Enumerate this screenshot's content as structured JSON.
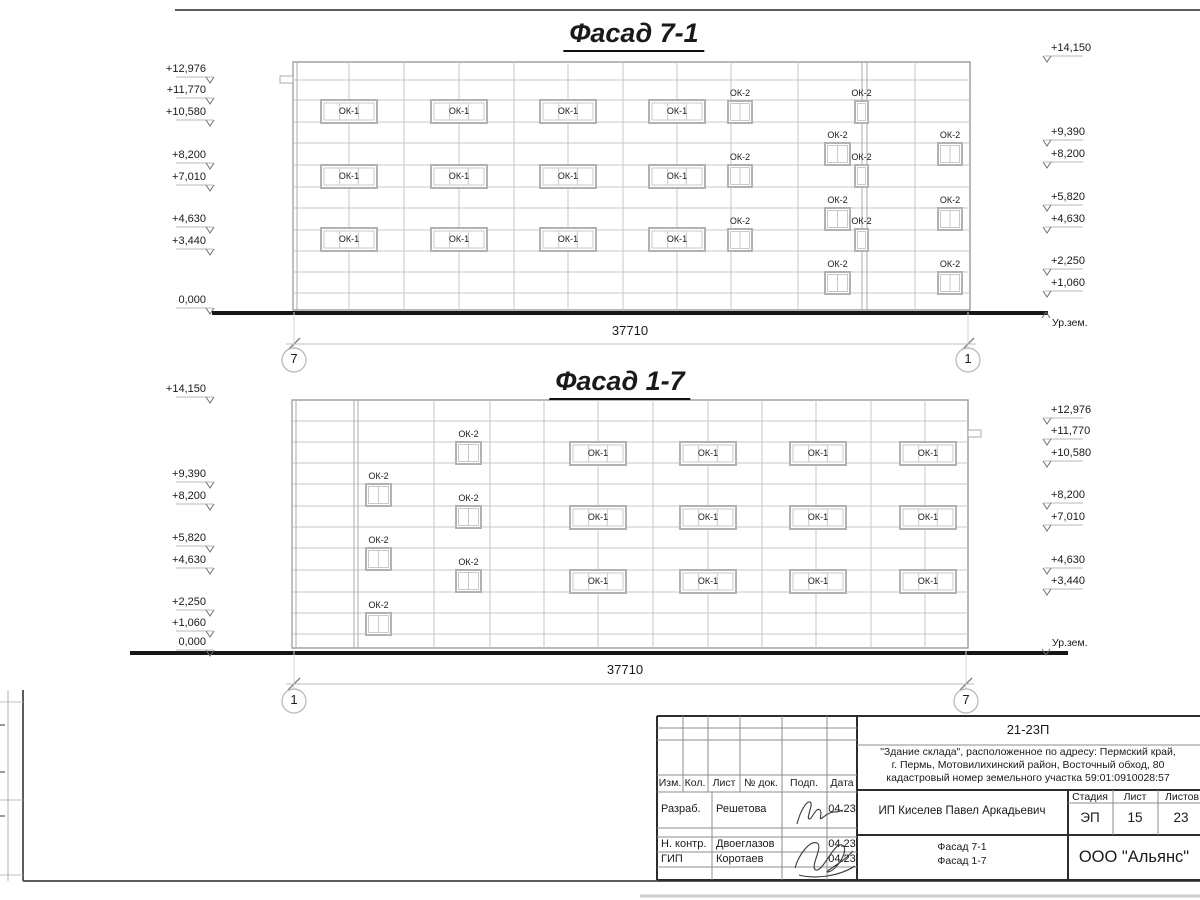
{
  "facades": [
    {
      "title": "Фасад 7-1",
      "title_x": 634,
      "title_y": 18,
      "left": 293,
      "right": 970,
      "top": 62,
      "bottom": 310,
      "h_lines": [
        80,
        100,
        122,
        143,
        165,
        187,
        208,
        230,
        251,
        272,
        293
      ],
      "v_lines": [
        349,
        404,
        459,
        514,
        568,
        623,
        677,
        731,
        798,
        915
      ],
      "v_double": [
        [
          293,
          297
        ],
        [
          862,
          867
        ]
      ],
      "notch": {
        "x": 280,
        "y": 76,
        "w": 13,
        "h": 7
      },
      "ok1_label": "ОК-1",
      "ok1_cols": [
        349,
        459,
        568,
        677
      ],
      "ok1_rows": [
        100,
        165,
        228
      ],
      "ok1_w": 56,
      "ok1_h": 23,
      "ok2_label": "ОК-2",
      "ok2_h": 22,
      "ok2": [
        {
          "x": 728,
          "y": 101,
          "w": 24
        },
        {
          "x": 728,
          "y": 165,
          "w": 24
        },
        {
          "x": 728,
          "y": 229,
          "w": 24
        },
        {
          "x": 855,
          "y": 101,
          "w": 13
        },
        {
          "x": 855,
          "y": 165,
          "w": 13
        },
        {
          "x": 855,
          "y": 229,
          "w": 13
        },
        {
          "x": 825,
          "y": 143,
          "w": 25
        },
        {
          "x": 825,
          "y": 208,
          "w": 25
        },
        {
          "x": 825,
          "y": 272,
          "w": 25
        },
        {
          "x": 938,
          "y": 143,
          "w": 24
        },
        {
          "x": 938,
          "y": 208,
          "w": 24
        },
        {
          "x": 938,
          "y": 272,
          "w": 24
        }
      ],
      "ground": {
        "x1": 212,
        "x2": 1048,
        "y": 313
      },
      "dim": {
        "text": "37710",
        "x1": 294,
        "x2": 968,
        "y": 344,
        "tx": 630,
        "ty": 324
      },
      "bubble_y": 360,
      "bubbles": [
        {
          "label": "7",
          "x": 294
        },
        {
          "label": "1",
          "x": 968
        }
      ],
      "marks_left": {
        "tick_x": 210,
        "items": [
          {
            "label": "+12,976",
            "y": 77
          },
          {
            "label": "+11,770",
            "y": 98
          },
          {
            "label": "+10,580",
            "y": 120
          },
          {
            "label": "+8,200",
            "y": 163
          },
          {
            "label": "+7,010",
            "y": 185
          },
          {
            "label": "+4,630",
            "y": 227
          },
          {
            "label": "+3,440",
            "y": 249
          },
          {
            "label": "0,000",
            "y": 308
          }
        ]
      },
      "marks_right": {
        "tick_x": 1047,
        "items": [
          {
            "label": "+14,150",
            "y": 56
          },
          {
            "label": "+9,390",
            "y": 140
          },
          {
            "label": "+8,200",
            "y": 162
          },
          {
            "label": "+5,820",
            "y": 205
          },
          {
            "label": "+4,630",
            "y": 227
          },
          {
            "label": "+2,250",
            "y": 269
          },
          {
            "label": "+1,060",
            "y": 291
          }
        ]
      },
      "ur_zem": {
        "label": "Ур.зем.",
        "x": 1052,
        "y": 317,
        "dir": "up"
      }
    },
    {
      "title": "Фасад 1-7",
      "title_x": 620,
      "title_y": 366,
      "left": 292,
      "right": 968,
      "top": 400,
      "bottom": 648,
      "h_lines": [
        421,
        442,
        463,
        484,
        506,
        527,
        548,
        570,
        592,
        613,
        634
      ],
      "v_lines": [
        434,
        490,
        544,
        598,
        653,
        708,
        762,
        816,
        871,
        925
      ],
      "v_double": [
        [
          292,
          296
        ],
        [
          354,
          358
        ]
      ],
      "notch": {
        "x": 968,
        "y": 430,
        "w": 13,
        "h": 7
      },
      "ok1_label": "ОК-1",
      "ok1_cols": [
        598,
        708,
        818,
        928
      ],
      "ok1_rows": [
        442,
        506,
        570
      ],
      "ok1_w": 56,
      "ok1_h": 23,
      "ok2_label": "ОК-2",
      "ok2_h": 22,
      "ok2": [
        {
          "x": 366,
          "y": 484,
          "w": 25
        },
        {
          "x": 366,
          "y": 548,
          "w": 25
        },
        {
          "x": 366,
          "y": 613,
          "w": 25
        },
        {
          "x": 456,
          "y": 442,
          "w": 25
        },
        {
          "x": 456,
          "y": 506,
          "w": 25
        },
        {
          "x": 456,
          "y": 570,
          "w": 25
        }
      ],
      "ground": {
        "x1": 130,
        "x2": 1068,
        "y": 653
      },
      "dim": {
        "text": "37710",
        "x1": 294,
        "x2": 966,
        "y": 684,
        "tx": 625,
        "ty": 663
      },
      "bubble_y": 701,
      "bubbles": [
        {
          "label": "1",
          "x": 294
        },
        {
          "label": "7",
          "x": 966
        }
      ],
      "marks_left": {
        "tick_x": 210,
        "items": [
          {
            "label": "+14,150",
            "y": 397
          },
          {
            "label": "+9,390",
            "y": 482
          },
          {
            "label": "+8,200",
            "y": 504
          },
          {
            "label": "+5,820",
            "y": 546
          },
          {
            "label": "+4,630",
            "y": 568
          },
          {
            "label": "+2,250",
            "y": 610
          },
          {
            "label": "+1,060",
            "y": 631
          },
          {
            "label": "0,000",
            "y": 650
          }
        ]
      },
      "marks_right": {
        "tick_x": 1047,
        "items": [
          {
            "label": "+12,976",
            "y": 418
          },
          {
            "label": "+11,770",
            "y": 439
          },
          {
            "label": "+10,580",
            "y": 461
          },
          {
            "label": "+8,200",
            "y": 503
          },
          {
            "label": "+7,010",
            "y": 525
          },
          {
            "label": "+4,630",
            "y": 568
          },
          {
            "label": "+3,440",
            "y": 589
          }
        ]
      },
      "ur_zem": {
        "label": "Ур.зем.",
        "x": 1052,
        "y": 637,
        "dir": "down"
      }
    }
  ],
  "title_block": {
    "code": "21-23П",
    "address": "\"Здание склада\", расположенное по адресу: Пермский край,\nг. Пермь, Мотовилихинский район, Восточный обход, 80\nкадастровый номер земельного участка 59:01:0910028:57",
    "client": "ИП Киселев Павел Аркадьевич",
    "doc_title": "Фасад 7-1\nФасад 1-7",
    "company": "ООО \"Альянс\"",
    "stage_label": "Стадия",
    "sheet_label": "Лист",
    "sheets_label": "Листов",
    "stage": "ЭП",
    "sheet_no": "15",
    "sheets_total": "23",
    "cols": [
      "Изм.",
      "Кол.",
      "Лист",
      "№ док.",
      "Подп.",
      "Дата"
    ],
    "rows": [
      {
        "role": "Разраб.",
        "name": "Решетова",
        "date": "04.23"
      },
      {
        "role": "Н. контр.",
        "name": "Двоеглазов",
        "date": "04.23"
      },
      {
        "role": "ГИП",
        "name": "Коротаев",
        "date": "04.23"
      }
    ]
  }
}
